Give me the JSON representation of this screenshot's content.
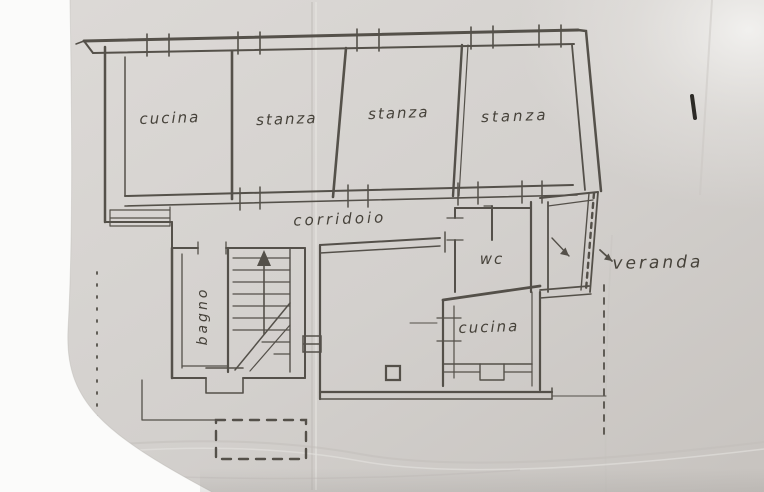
{
  "plan": {
    "room_labels": {
      "cucina_top": "cucina",
      "stanza_left": "stanza",
      "stanza_middle": "stanza",
      "stanza_right": "stanza",
      "corridoio": "corridoio",
      "wc": "wc",
      "bagno": "bagno",
      "cucina_lower": "cucina",
      "veranda": "veranda"
    },
    "colors": {
      "ink": "#45413a",
      "ink_dark": "#2c2a26",
      "paper_light": "#dedbd8",
      "paper_dark": "#c8c4c0",
      "margin_white": "#fbfbfa"
    }
  }
}
